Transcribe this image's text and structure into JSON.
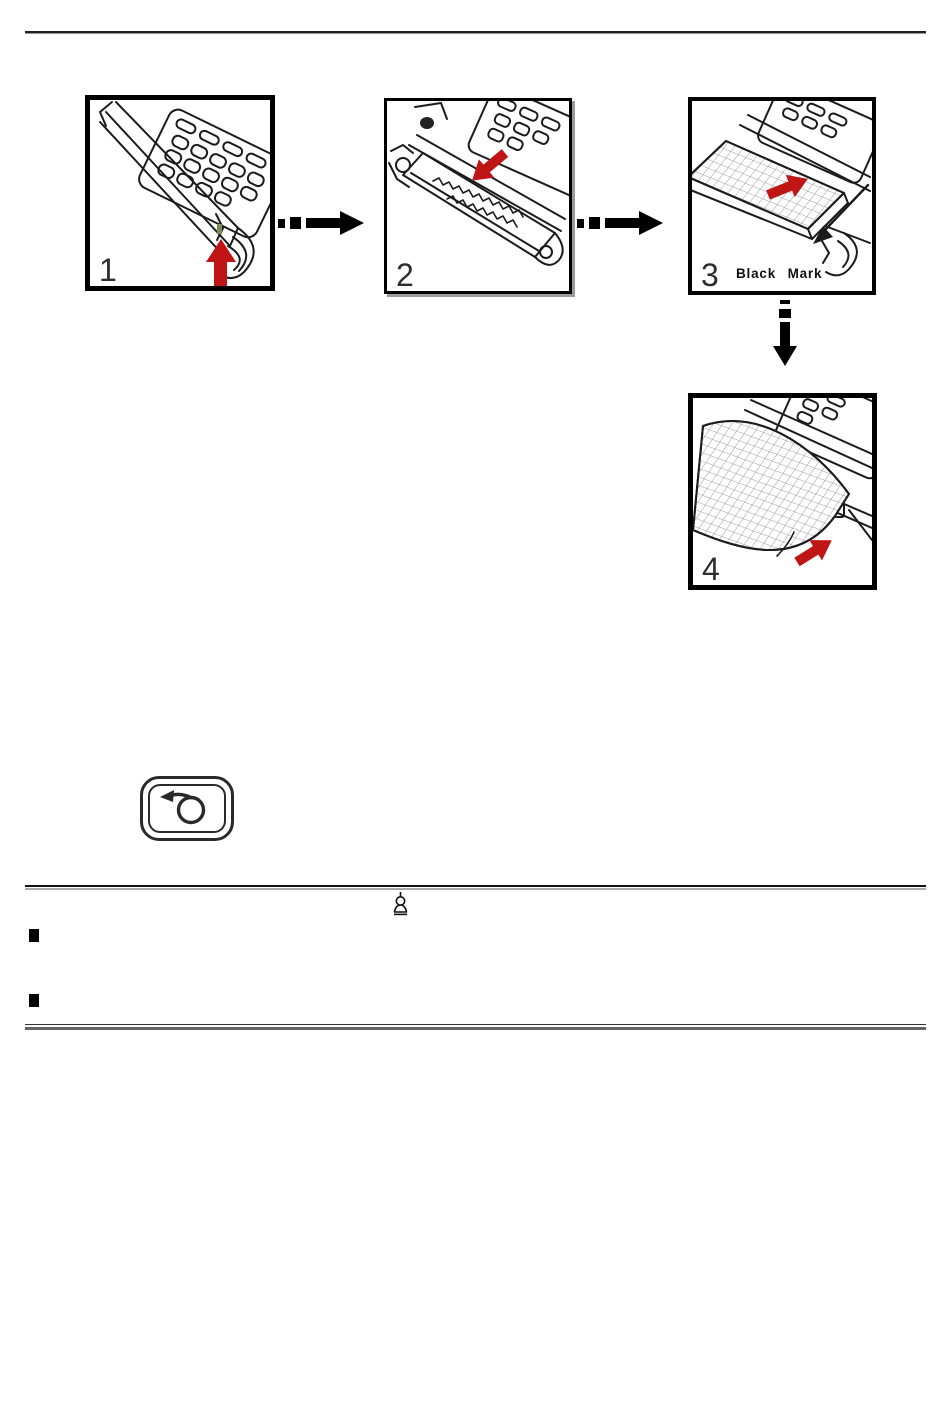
{
  "page": {
    "background": "#ffffff",
    "line_art_color": "#1c1c1c",
    "accent_red": "#c01515",
    "rule_dark": "#222222",
    "rule_gray": "#666666"
  },
  "figure": {
    "panels": [
      {
        "number": "1"
      },
      {
        "number": "2"
      },
      {
        "number": "3",
        "annotation": "Black Mark"
      },
      {
        "number": "4"
      }
    ]
  },
  "icons": {
    "connector_right": "dashed-arrow-right-icon",
    "connector_down": "dashed-arrow-down-icon",
    "feed_key": "feed-loop-arrow-icon",
    "note": "note-icon",
    "red_arrow": "red-direction-arrow-icon"
  }
}
